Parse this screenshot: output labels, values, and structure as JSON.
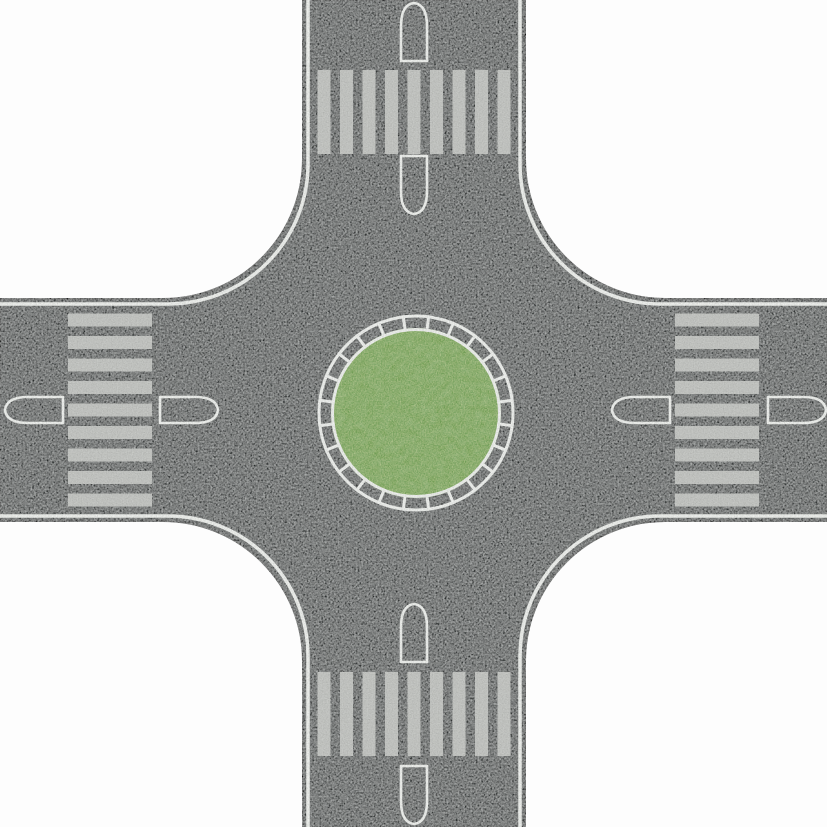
{
  "scene": {
    "canvas": {
      "width": 827,
      "height": 827
    },
    "colors": {
      "paper": "#fdfdfd",
      "asphalt": "#2b2d2e",
      "asphalt_edge": "#141617",
      "marking_white": "#eff1ee",
      "stripe_gray": "#c6c8c5",
      "grass_green": "#6e9c53"
    },
    "road": {
      "center_x": 414,
      "center_y": 410,
      "asphalt_half_width": 111,
      "line_half_width": 106,
      "corner_fillet_radius": 140,
      "edge_line_width": 3.5,
      "asphalt_edge_stroke": 2
    },
    "roundabout": {
      "center_x": 416,
      "center_y": 413,
      "outer_ring_radius": 97,
      "inner_ring_radius": 83.5,
      "ring_line_width": 3,
      "tick_count": 24,
      "tick_offset_deg": 7.5,
      "tick_inner_radius": 82,
      "tick_outer_radius": 98.5,
      "grass_radius": 85
    },
    "crosswalks": {
      "stripe_count": 9,
      "stripe_thickness": 13,
      "stripe_pitch": 22.5,
      "first_offset_vertical_road": 317.5,
      "first_offset_horizontal_road": 313.5,
      "arms": [
        {
          "id": "top",
          "orientation": "vertical",
          "band_start": 70,
          "band_end": 154
        },
        {
          "id": "bottom",
          "orientation": "vertical",
          "band_start": 672,
          "band_end": 756
        },
        {
          "id": "left",
          "orientation": "horizontal",
          "band_start": 68,
          "band_end": 152
        },
        {
          "id": "right",
          "orientation": "horizontal",
          "band_start": 675,
          "band_end": 759
        }
      ]
    },
    "islands": {
      "length": 58,
      "half_width": 13,
      "outline_width": 2.6,
      "placements": [
        {
          "id": "top-outer",
          "x": 414,
          "y": 3,
          "rot": 0
        },
        {
          "id": "top-inner",
          "x": 414,
          "y": 214,
          "rot": 180
        },
        {
          "id": "bottom-inner",
          "x": 414,
          "y": 604,
          "rot": 0
        },
        {
          "id": "bottom-outer",
          "x": 414,
          "y": 824,
          "rot": 180
        },
        {
          "id": "left-outer",
          "x": 5,
          "y": 410,
          "rot": -90
        },
        {
          "id": "left-inner",
          "x": 218,
          "y": 410,
          "rot": 90
        },
        {
          "id": "right-inner",
          "x": 612,
          "y": 410,
          "rot": -90
        },
        {
          "id": "right-outer",
          "x": 826,
          "y": 410,
          "rot": 90
        }
      ]
    }
  }
}
